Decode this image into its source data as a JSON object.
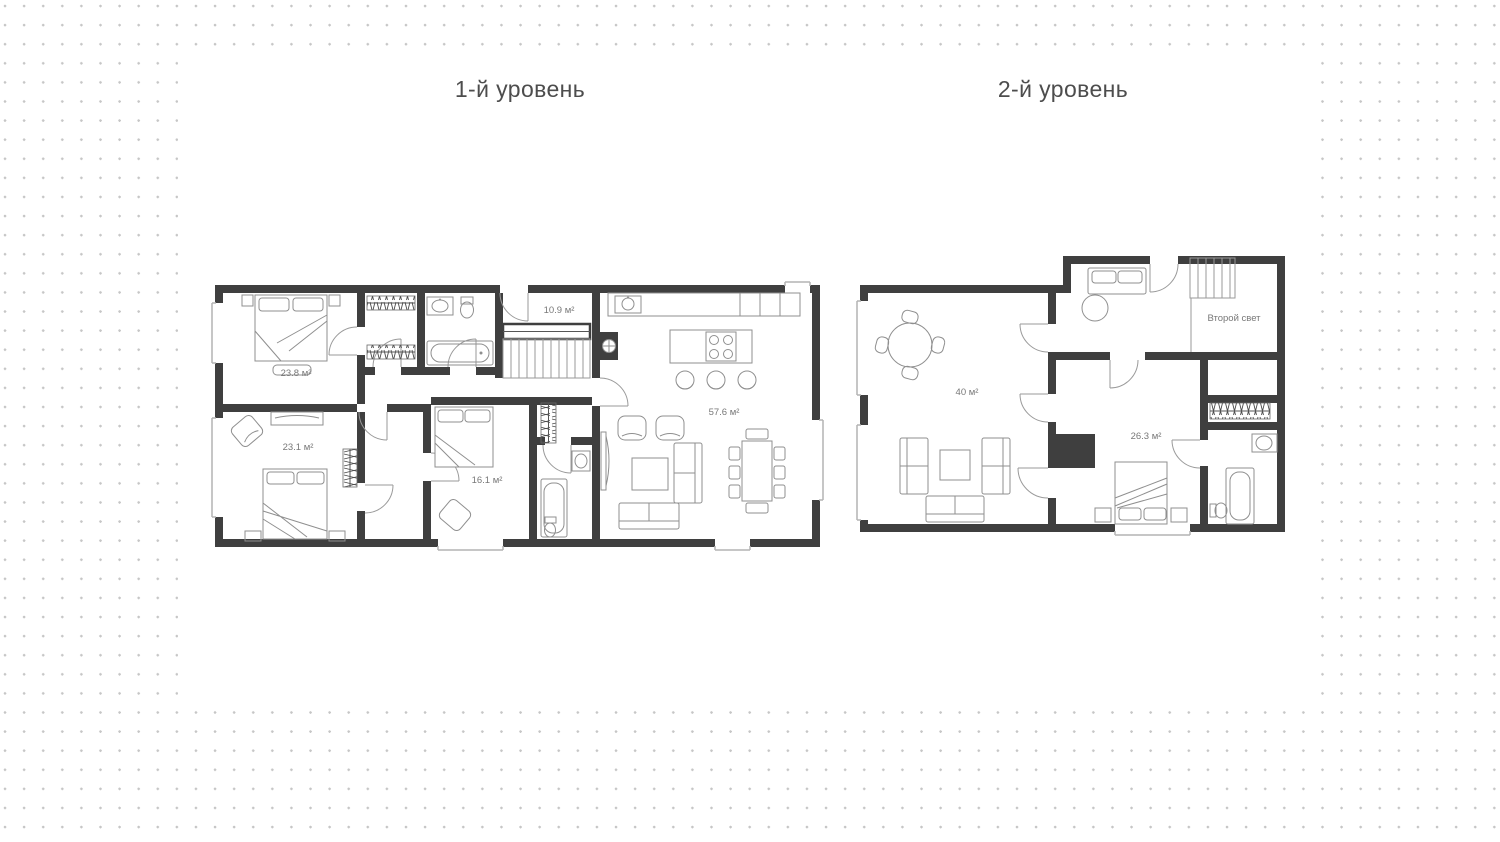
{
  "page": {
    "background_dot_color": "#c6c6c6",
    "panel_color": "#ffffff"
  },
  "colors": {
    "wall": "#3f3f3f",
    "furniture": "#8f8f8f",
    "window": "#b3b3b3",
    "label": "#787878",
    "title": "#4d4d4d"
  },
  "levels": [
    {
      "title": "1-й уровень",
      "rooms": [
        {
          "name": "bedroom-top-left",
          "area": "23.8 м²"
        },
        {
          "name": "hallway",
          "area": "10.9 м²"
        },
        {
          "name": "kitchen-living",
          "area": "57.6 м²"
        },
        {
          "name": "bedroom-bottom-left",
          "area": "23.1 м²"
        },
        {
          "name": "bedroom-middle",
          "area": "16.1 м²"
        }
      ]
    },
    {
      "title": "2-й уровень",
      "rooms": [
        {
          "name": "lounge",
          "area": "40 м²"
        },
        {
          "name": "void-over-living",
          "area": "Второй свет"
        },
        {
          "name": "bedroom-upper",
          "area": "26.3 м²"
        }
      ]
    }
  ]
}
